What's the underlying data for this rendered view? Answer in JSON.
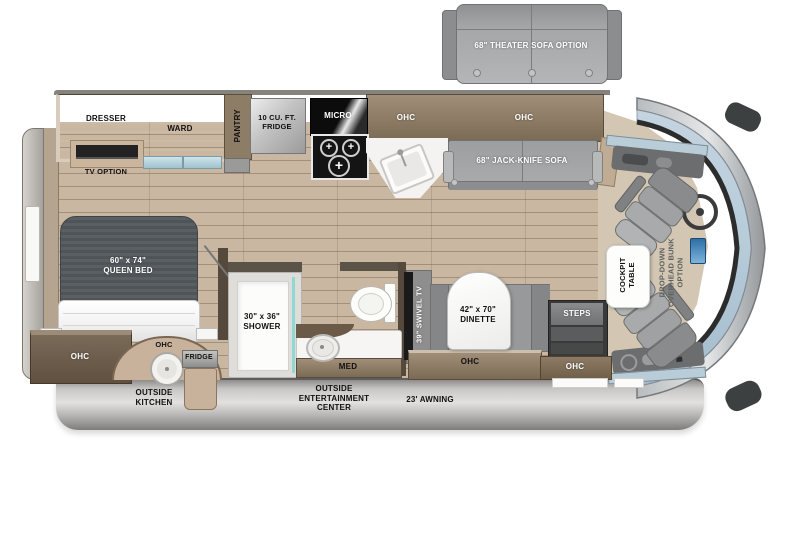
{
  "title": "RV floorplan",
  "exterior": {
    "theater_sofa": "68\" THEATER SOFA OPTION",
    "outside_kitchen": "OUTSIDE\nKITCHEN",
    "outside_entertainment": "OUTSIDE\nENTERTAINMENT\nCENTER",
    "awning": "23' AWNING",
    "fridge_outside": "FRIDGE",
    "ohc_outside_kitchen": "OHC"
  },
  "bedroom": {
    "dresser": "DRESSER",
    "ward": "WARD",
    "pantry": "PANTRY",
    "tv_option": "TV OPTION",
    "queen_bed": "60\" x 74\"\nQUEEN BED",
    "ohc_bed_foot": "OHC"
  },
  "kitchen": {
    "fridge_10": "10 CU. FT.\nFRIDGE",
    "micro": "MICRO",
    "ohc_kitchen": "OHC",
    "ohc_sofa": "OHC"
  },
  "living": {
    "jack_knife_sofa": "68\" JACK-KNIFE SOFA",
    "swivel_tv": "39\" SWIVEL TV",
    "dinette": "42\" x 70\"\nDINETTE",
    "ohc_dinette": "OHC",
    "steps": "STEPS",
    "ohc_entry": "OHC"
  },
  "bath": {
    "shower": "30\" x 36\"\nSHOWER",
    "med": "MED"
  },
  "cockpit": {
    "cockpit_table": "COCKPIT\nTABLE",
    "drop_down_bunk": "DROP-DOWN\nOVERHEAD BUNK\nOPTION"
  },
  "palette": {
    "floor_wood": "#c9b7a2",
    "dark_cabinet": "#6f6050",
    "ohc_wood": "#8d7b66",
    "furniture_gray": "#9c9e9f",
    "windshield_blue": "#b7cbd9",
    "exterior_gray": "#c9c7c5",
    "mattress_gray": "#555a5f",
    "shower_glass_teal": "#8fd9d2"
  }
}
